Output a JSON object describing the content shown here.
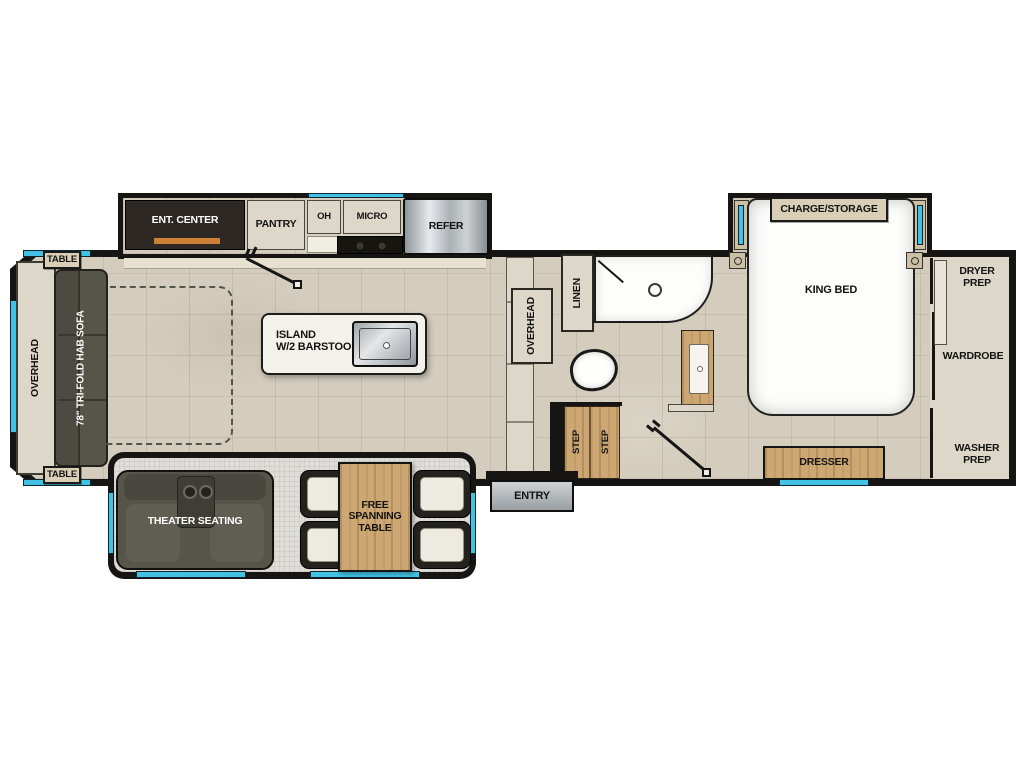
{
  "colors": {
    "wall": "#161514",
    "floor": "#d4cdbe",
    "accent_window": "#41c2e5",
    "wood": "#cda773",
    "cabinet": "#dcd7c8",
    "dark_cabinet": "#2d2823",
    "sofa": "#57544a",
    "metal": "#aeb3b7",
    "orange": "#cd7f36"
  },
  "front_lounge": {
    "overhead": "OVERHEAD",
    "table_top": "TABLE",
    "table_bottom": "TABLE",
    "sofa": "78\" TRI-FOLD HAB SOFA"
  },
  "kitchen": {
    "ent_center": "ENT. CENTER",
    "pantry": "PANTRY",
    "oh": "OH",
    "micro": "MICRO",
    "refer": "REFER",
    "island": "ISLAND\nW/2 BARSTOOLS"
  },
  "bath": {
    "overhead": "OVERHEAD",
    "linen": "LINEN",
    "steps": [
      "STEP",
      "STEP"
    ]
  },
  "entry": {
    "label": "ENTRY"
  },
  "bedroom": {
    "charge_storage": "CHARGE/STORAGE",
    "king_bed": "KING BED",
    "dresser": "DRESSER"
  },
  "rear_closet": {
    "dryer_prep": "DRYER PREP",
    "wardrobe": "WARDROBE",
    "washer_prep": "WASHER PREP"
  },
  "dinette_slide": {
    "theater_seating": "THEATER SEATING",
    "table": "FREE SPANNING TABLE"
  }
}
